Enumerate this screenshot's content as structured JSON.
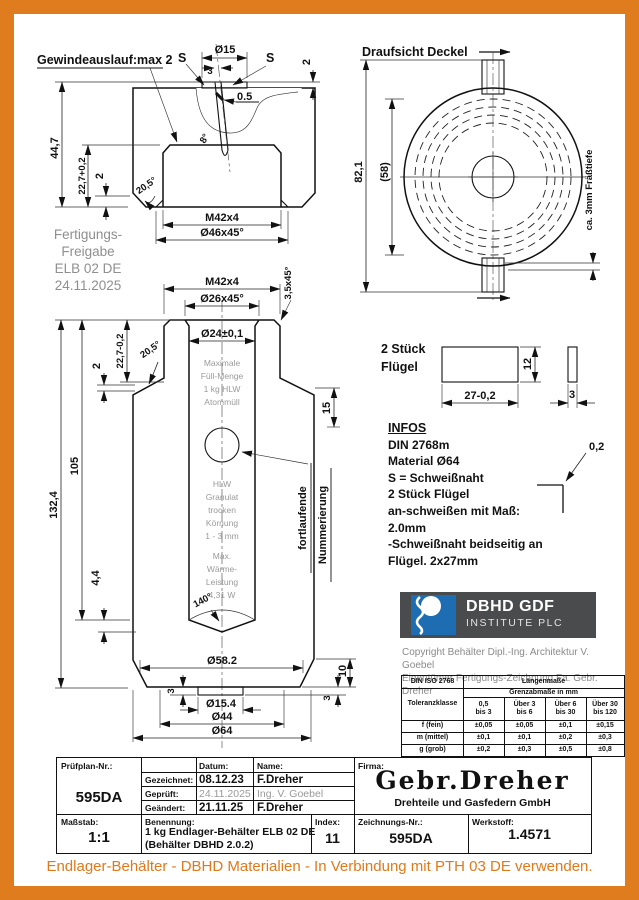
{
  "lid": {
    "callout": "Gewindeauslauf:max 2",
    "s_left": "S",
    "s_right": "S",
    "dia15": "Ø15",
    "slot3": "3",
    "gap05": "0.5",
    "angle8": "8°",
    "plate2": "2",
    "h447": "44,7",
    "h227": "22,7+0,2",
    "d2": "2",
    "a205": "20,5°",
    "thread": "M42x4",
    "cham46": "Ø46x45°"
  },
  "release": {
    "l1": "Fertigungs-",
    "l2": "Freigabe",
    "l3": "ELB 02 DE",
    "l4": "24.11.2025"
  },
  "topview": {
    "title": "Draufsicht Deckel",
    "d821": "82,1",
    "d58": "(58)",
    "mill": "ca. 3mm Fräßtiefe"
  },
  "body": {
    "thread": "M42x4",
    "cham26": "Ø26x45°",
    "cham35": "3,5x45°",
    "bore": "Ø24±0,1",
    "h227": "22,7-0,2",
    "d2": "2",
    "a205": "20,5°",
    "h105": "105",
    "h1324": "132,4",
    "d15": "15",
    "d44": "4,4",
    "a140": "140°",
    "d582": "Ø58.2",
    "d3l": "3",
    "d3r": "3",
    "d10": "10",
    "d154": "Ø15.4",
    "d44b": "Ø44",
    "d64": "Ø64",
    "fill": [
      "Maximale",
      "Füll-Menge",
      "1 kg HLW",
      "Atommüll"
    ],
    "gran": [
      "HLW",
      "Granulat",
      "trocken",
      "Körnung",
      "1 - 3 mm"
    ],
    "heat": [
      "Max.",
      "Wärme-",
      "Leistung",
      "4,31 W"
    ],
    "num1": "fortlaufende",
    "num2": "Nummerierung"
  },
  "wing": {
    "l1": "2 Stück",
    "l2": "Flügel",
    "w": "27-0,2",
    "h": "12",
    "t": "3"
  },
  "infos": {
    "title": "INFOS",
    "lines": [
      "DIN 2768m",
      "Material Ø64",
      "S = Schweißnaht",
      "2 Stück Flügel",
      "an-schweißen mit Maß:",
      "2.0mm",
      "-Schweißnaht beidseitig an",
      "Flügel. 2x27mm"
    ],
    "gap": "0,2"
  },
  "logo": {
    "l1": "DBHD GDF",
    "l2": "INSTITUTE PLC"
  },
  "copyright": {
    "l1": "Copyright Behälter Dipl.-Ing. Architektur V. Goebel",
    "l2": "Eigentümer Fertigungs-Zeichnung Fa. Gebr. Dreher"
  },
  "tol": {
    "corner": "DIN ISO 2768",
    "span": "Längenmaße",
    "sub": "Grenzabmaße in mm",
    "klass": "Toleranzklasse",
    "cols": [
      {
        "l1": "0,5",
        "l2": "bis 3"
      },
      {
        "l1": "Über 3",
        "l2": "bis 6"
      },
      {
        "l1": "Über 6",
        "l2": "bis 30"
      },
      {
        "l1": "Über 30",
        "l2": "bis 120"
      }
    ],
    "rows": [
      {
        "label": "f (fein)",
        "v0": "±0,05",
        "v1": "±0,05",
        "v2": "±0,1",
        "v3": "±0,15"
      },
      {
        "label": "m (mittel)",
        "v0": "±0,1",
        "v1": "±0,1",
        "v2": "±0,2",
        "v3": "±0,3"
      },
      {
        "label": "g (grob)",
        "v0": "±0,2",
        "v1": "±0,3",
        "v2": "±0,5",
        "v3": "±0,8"
      }
    ]
  },
  "tb": {
    "pruefplan_label": "Prüfplan-Nr.:",
    "pruefplan_value": "595DA",
    "datum_label": "Datum:",
    "name_label": "Name:",
    "rows": [
      {
        "label": "Gezeichnet:",
        "date": "08.12.23",
        "name": "F.Dreher"
      },
      {
        "label": "Geprüft:",
        "date": "24.11.2025",
        "name": "Ing. V. Goebel"
      },
      {
        "label": "Geändert:",
        "date": "21.11.25",
        "name": "F.Dreher"
      }
    ],
    "firma_label": "Firma:",
    "firma_name": "Gebr.Dreher",
    "firma_sub": "Drehteile und Gasfedern GmbH",
    "massstab_label": "Maßstab:",
    "massstab_value": "1:1",
    "benennung_label": "Benennung:",
    "benennung_l1": "1 kg Endlager-Behälter ELB 02 DE",
    "benennung_l2": "(Behälter DBHD 2.0.2)",
    "index_label": "Index:",
    "index_value": "11",
    "zeichnung_label": "Zeichnungs-Nr.:",
    "zeichnung_value": "595DA",
    "werkstoff_label": "Werkstoff:",
    "werkstoff_value": "1.4571"
  },
  "footer": "Endlager-Behälter - DBHD Materialien - In Verbindung mit PTH 03 DE verwenden."
}
